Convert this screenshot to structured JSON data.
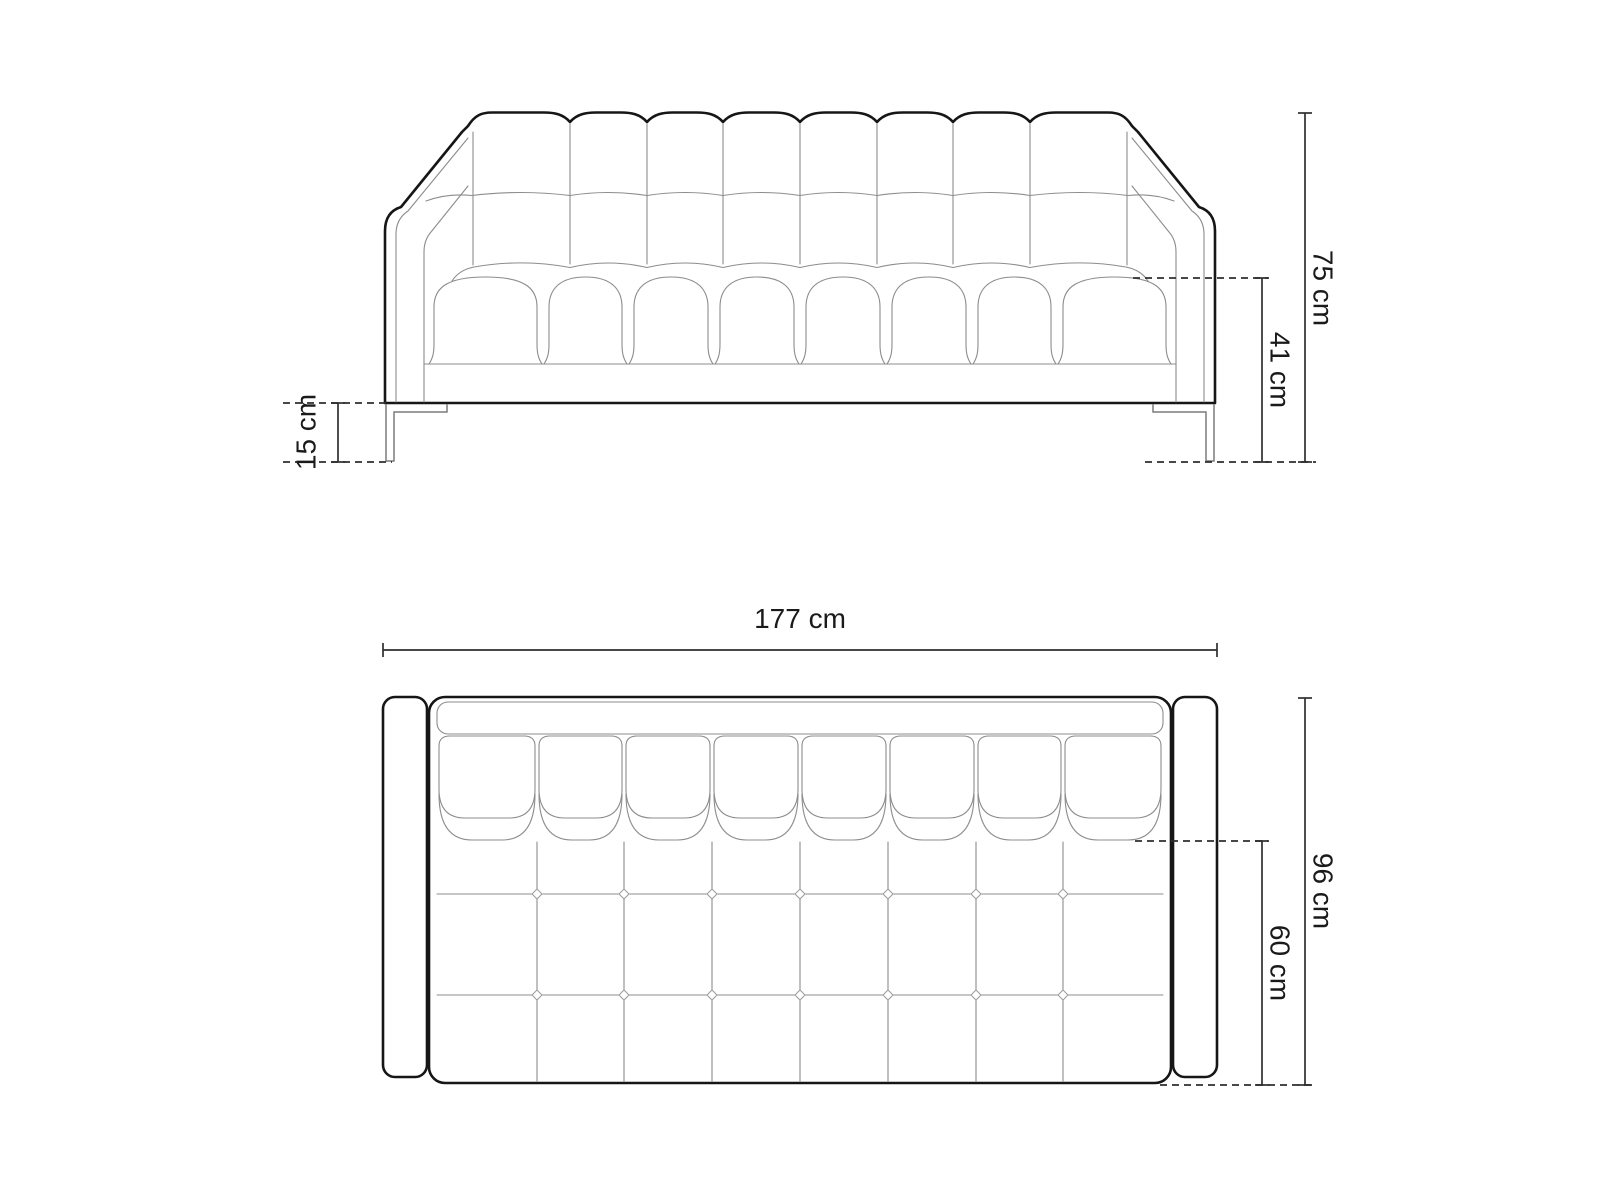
{
  "diagram": {
    "subject": "sofa-technical-drawing",
    "views": {
      "front": "front-elevation",
      "top": "top-plan"
    },
    "dimensions": {
      "total_height": "75 cm",
      "seat_height": "41 cm",
      "leg_height": "15 cm",
      "total_width": "177 cm",
      "total_depth": "96 cm",
      "seat_depth": "60 cm"
    },
    "colors": {
      "outline": "#161616",
      "seam": "#8c8c8c",
      "dimension_line": "#2e2e2e",
      "label_text": "#1a1a1a",
      "background": "#ffffff"
    }
  }
}
